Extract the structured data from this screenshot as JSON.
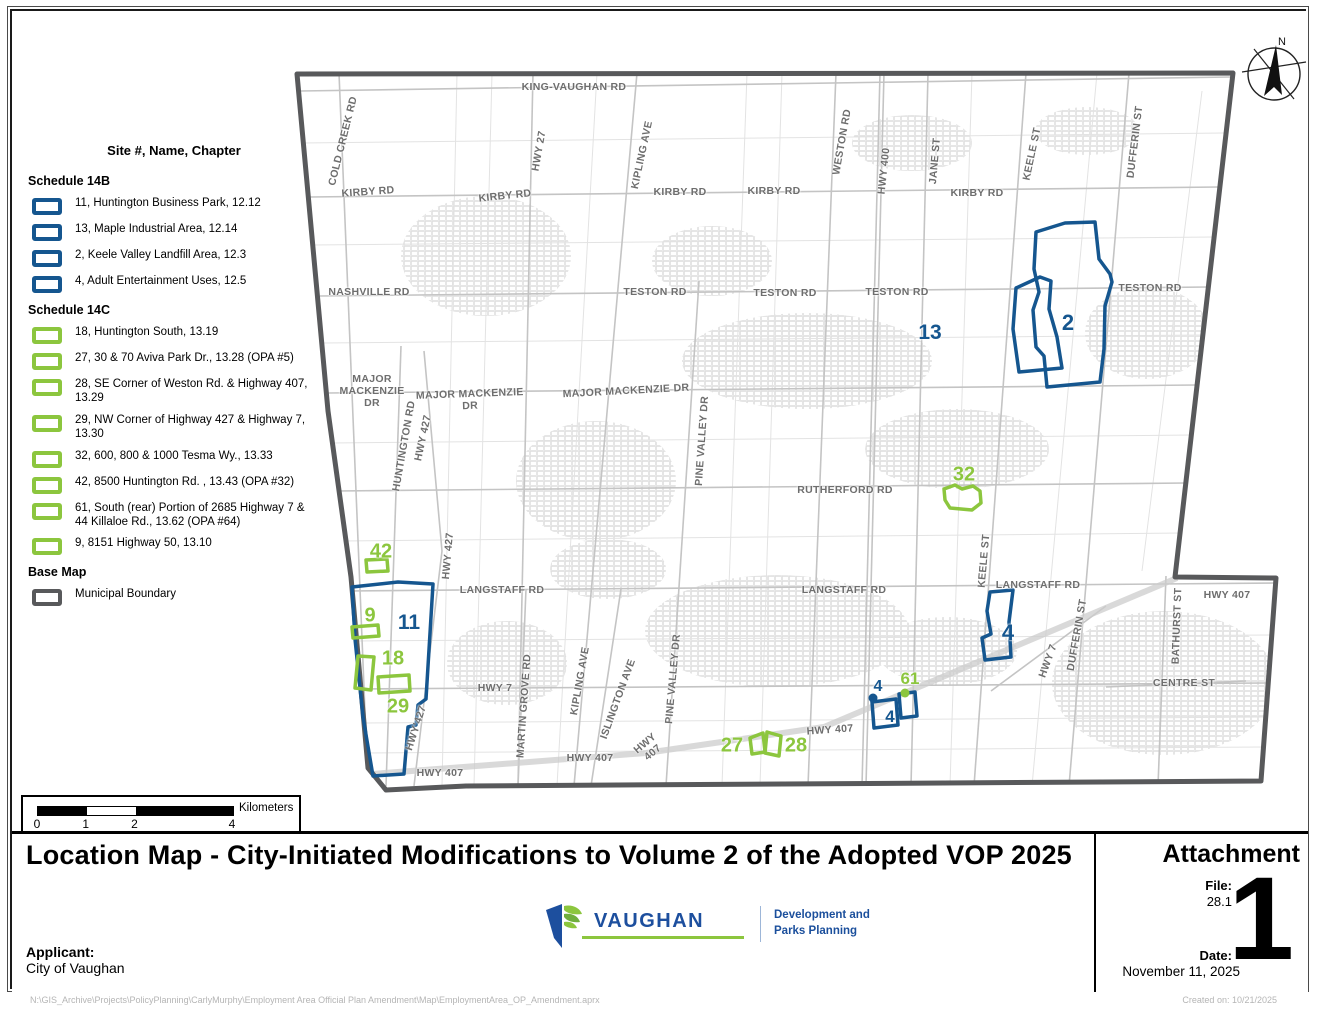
{
  "colors": {
    "site_blue": "#15568f",
    "site_green": "#8cc63e",
    "boundary_gray": "#58595b",
    "logo_blue": "#1d4f9e",
    "logo_green": "#8cc63e"
  },
  "legend": {
    "title": "Site #, Name, Chapter",
    "sections": [
      {
        "header": "Schedule 14B",
        "swatch": "blue",
        "items": [
          "11, Huntington Business Park, 12.12",
          "13, Maple Industrial Area, 12.14",
          "2, Keele Valley Landfill Area, 12.3",
          "4, Adult Entertainment Uses, 12.5"
        ]
      },
      {
        "header": "Schedule 14C",
        "swatch": "green",
        "items": [
          "18, Huntington South, 13.19",
          "27, 30 & 70 Aviva Park Dr., 13.28 (OPA #5)",
          "28, SE Corner of Weston Rd. & Highway 407, 13.29",
          "29, NW Corner of Highway 427 & Highway 7, 13.30",
          "32, 600, 800 & 1000 Tesma Wy., 13.33",
          "42, 8500 Huntington Rd. , 13.43 (OPA #32)",
          "61, South (rear) Portion of 2685 Highway 7 & 44 Killaloe Rd., 13.62 (OPA #64)",
          "9, 8151 Highway 50, 13.10"
        ]
      },
      {
        "header": "Base Map",
        "swatch": "gray",
        "items": [
          "Municipal Boundary"
        ]
      }
    ]
  },
  "scale_bar": {
    "unit": "Kilometers",
    "ticks": [
      {
        "label": "0",
        "pos": 0
      },
      {
        "label": "1",
        "pos": 0.25
      },
      {
        "label": "2",
        "pos": 0.5
      },
      {
        "label": "4",
        "pos": 1
      }
    ]
  },
  "compass": {
    "label": "N"
  },
  "map": {
    "road_labels": [
      {
        "t": "KING-VAUGHAN RD",
        "x": 562,
        "y": 76,
        "r": 0
      },
      {
        "t": "KIRBY RD",
        "x": 356,
        "y": 181,
        "r": -4
      },
      {
        "t": "KIRBY RD",
        "x": 493,
        "y": 185,
        "r": -6
      },
      {
        "t": "KIRBY RD",
        "x": 668,
        "y": 181,
        "r": 0
      },
      {
        "t": "KIRBY RD",
        "x": 762,
        "y": 180,
        "r": 0
      },
      {
        "t": "KIRBY RD",
        "x": 965,
        "y": 182,
        "r": 0
      },
      {
        "t": "NASHVILLE RD",
        "x": 357,
        "y": 281,
        "r": 0
      },
      {
        "t": "TESTON RD",
        "x": 643,
        "y": 281,
        "r": 0
      },
      {
        "t": "TESTON RD",
        "x": 773,
        "y": 282,
        "r": 0
      },
      {
        "t": "TESTON RD",
        "x": 885,
        "y": 281,
        "r": 0
      },
      {
        "t": "TESTON RD",
        "x": 1138,
        "y": 277,
        "r": 0
      },
      {
        "t": "MAJOR\nMACKENZIE\nDR",
        "x": 360,
        "y": 380,
        "r": 0
      },
      {
        "t": "MAJOR MACKENZIE\nDR",
        "x": 458,
        "y": 389,
        "r": -2
      },
      {
        "t": "MAJOR MACKENZIE DR",
        "x": 614,
        "y": 380,
        "r": -3
      },
      {
        "t": "RUTHERFORD RD",
        "x": 833,
        "y": 479,
        "r": 0
      },
      {
        "t": "LANGSTAFF RD",
        "x": 490,
        "y": 579,
        "r": 0
      },
      {
        "t": "LANGSTAFF RD",
        "x": 832,
        "y": 579,
        "r": 0
      },
      {
        "t": "LANGSTAFF RD",
        "x": 1026,
        "y": 574,
        "r": 0
      },
      {
        "t": "HWY 7",
        "x": 483,
        "y": 677,
        "r": 0
      },
      {
        "t": "HWY 407",
        "x": 428,
        "y": 762,
        "r": 0
      },
      {
        "t": "HWY 407",
        "x": 578,
        "y": 747,
        "r": 0
      },
      {
        "t": "HWY\n407",
        "x": 637,
        "y": 737,
        "r": -40
      },
      {
        "t": "HWY 407",
        "x": 818,
        "y": 719,
        "r": -4
      },
      {
        "t": "HWY 407",
        "x": 1215,
        "y": 584,
        "r": 0
      },
      {
        "t": "CENTRE ST",
        "x": 1172,
        "y": 672,
        "r": 0
      },
      {
        "t": "COLD CREEK RD",
        "x": 331,
        "y": 130,
        "r": -76
      },
      {
        "t": "HWY 27",
        "x": 527,
        "y": 140,
        "r": -80
      },
      {
        "t": "KIPLING AVE",
        "x": 630,
        "y": 144,
        "r": -78
      },
      {
        "t": "WESTON RD",
        "x": 830,
        "y": 131,
        "r": -80
      },
      {
        "t": "HWY 400",
        "x": 872,
        "y": 160,
        "r": -84
      },
      {
        "t": "JANE ST",
        "x": 923,
        "y": 150,
        "r": -85
      },
      {
        "t": "KEELE ST",
        "x": 1020,
        "y": 143,
        "r": -78
      },
      {
        "t": "DUFFERIN ST",
        "x": 1123,
        "y": 131,
        "r": -83
      },
      {
        "t": "KEELE ST",
        "x": 972,
        "y": 550,
        "r": -85
      },
      {
        "t": "DUFFERIN ST",
        "x": 1065,
        "y": 624,
        "r": -80
      },
      {
        "t": "BATHURST ST",
        "x": 1165,
        "y": 615,
        "r": -88
      },
      {
        "t": "HWY 7",
        "x": 1036,
        "y": 650,
        "r": -70
      },
      {
        "t": "HUNTINGTON RD",
        "x": 392,
        "y": 435,
        "r": -80
      },
      {
        "t": "HWY 427",
        "x": 411,
        "y": 427,
        "r": -78
      },
      {
        "t": "HWY 427",
        "x": 436,
        "y": 545,
        "r": -85
      },
      {
        "t": "HWY'427",
        "x": 404,
        "y": 717,
        "r": -72
      },
      {
        "t": "MARTIN GROVE RD",
        "x": 512,
        "y": 695,
        "r": -86
      },
      {
        "t": "KIPLING AVE",
        "x": 568,
        "y": 670,
        "r": -80
      },
      {
        "t": "ISLINGTON AVE",
        "x": 606,
        "y": 688,
        "r": -70
      },
      {
        "t": "PINE VALLEY DR",
        "x": 690,
        "y": 430,
        "r": -86
      },
      {
        "t": "PINE VALLEY DR",
        "x": 661,
        "y": 668,
        "r": -85
      }
    ],
    "site_labels": [
      {
        "t": "13",
        "x": 918,
        "y": 322,
        "c": "blue",
        "s": 21
      },
      {
        "t": "2",
        "x": 1056,
        "y": 312,
        "c": "blue",
        "s": 22
      },
      {
        "t": "32",
        "x": 952,
        "y": 464,
        "c": "green",
        "s": 20
      },
      {
        "t": "42",
        "x": 369,
        "y": 541,
        "c": "green",
        "s": 20
      },
      {
        "t": "9",
        "x": 358,
        "y": 605,
        "c": "green",
        "s": 20
      },
      {
        "t": "11",
        "x": 397,
        "y": 612,
        "c": "blue",
        "s": 21
      },
      {
        "t": "18",
        "x": 381,
        "y": 648,
        "c": "green",
        "s": 20
      },
      {
        "t": "29",
        "x": 386,
        "y": 696,
        "c": "green",
        "s": 20
      },
      {
        "t": "27",
        "x": 720,
        "y": 735,
        "c": "green",
        "s": 20
      },
      {
        "t": "28",
        "x": 784,
        "y": 735,
        "c": "green",
        "s": 20
      },
      {
        "t": "4",
        "x": 866,
        "y": 676,
        "c": "blue",
        "s": 16
      },
      {
        "t": "61",
        "x": 898,
        "y": 668,
        "c": "green",
        "s": 17
      },
      {
        "t": "4",
        "x": 878,
        "y": 706,
        "c": "blue",
        "s": 17
      },
      {
        "t": "4",
        "x": 996,
        "y": 622,
        "c": "blue",
        "s": 22
      }
    ]
  },
  "title_block": {
    "title": "Location Map - City-Initiated Modifications to Volume 2 of the Adopted VOP 2025",
    "attachment_label": "Attachment",
    "file_label": "File:",
    "file_value": "28.1",
    "attachment_number": "1",
    "date_label": "Date:",
    "date_value": "November 11, 2025",
    "applicant_label": "Applicant:",
    "applicant_value": "City of Vaughan",
    "logo_text": "VAUGHAN",
    "logo_dept": "Development and\nParks Planning"
  },
  "footer": {
    "path": "N:\\GIS_Archive\\Projects\\PolicyPlanning\\CarlyMurphy\\Employment Area Official Plan Amendment\\Map\\EmploymentArea_OP_Amendment.aprx",
    "created": "Created on: 10/21/2025"
  }
}
